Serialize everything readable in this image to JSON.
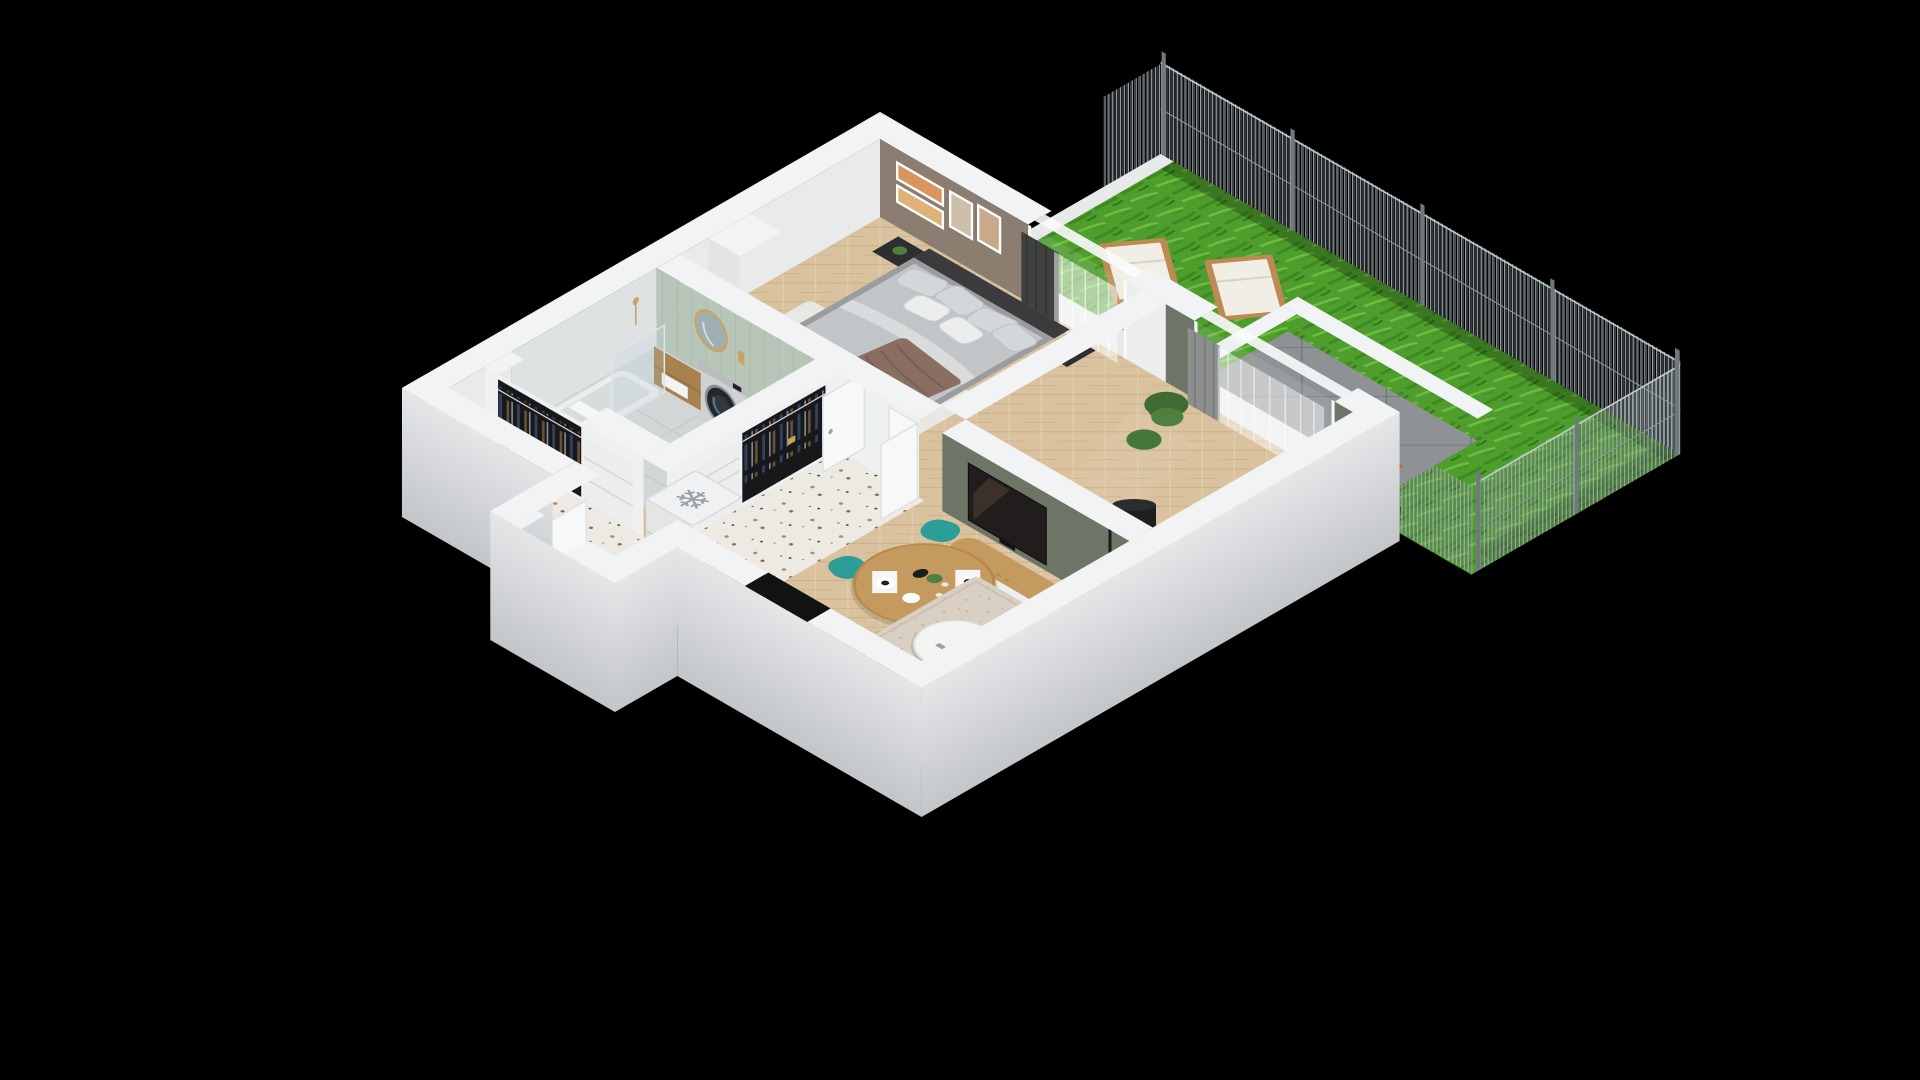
{
  "title": "3D isometric apartment floor plan with garden",
  "icons": {
    "freezer": "❄"
  },
  "palette": {
    "bg": "#000000",
    "wallTop": "#f2f3f4",
    "wallExt1": "#e4e6e8",
    "wallExt2": "#c3c6c9",
    "wallInner": "#eef0f1",
    "taupe": "#8b7e71",
    "sage": "#b7c6b8",
    "partition": "#6d7567",
    "wood1": "#d9c29d",
    "wood2": "#cbb188",
    "terrazzo": "#edeae4",
    "bathFloor": "#d3d6d7",
    "terrace": "#8e9294",
    "terraceLine": "#6f7478",
    "grass1": "#4f9e2d",
    "grass2": "#3a8a1e",
    "grass3": "#6dbf40",
    "fence": "#9fabaf",
    "rug": "#d9cfc2",
    "sofa": "#7c4a43",
    "teal": "#2d9d95",
    "tv": "#201d1c",
    "counter": "#3a3c3d",
    "gold": "#c9a35f",
    "woodFurn": "#c59a5e",
    "curtainDark": "#3f4140",
    "curtainGray": "#8c8f8e",
    "whiteFurn": "#f4f5f5"
  },
  "scene": {
    "background": "#000000",
    "view": "isometric cut-away 3D render on black background",
    "garden": {
      "ground": "lawn",
      "items": [
        "wire-mesh-fence",
        "sun-lounger",
        "sun-lounger"
      ]
    },
    "terrace": {
      "ground": "large gray tiles",
      "items": [
        "low-white-wall",
        "doormat",
        "sheer-curtains"
      ]
    },
    "rooms": [
      {
        "name": "Bedroom",
        "floor": "herringbone-wood",
        "items": [
          "double-bed",
          "gray-bedding",
          "pillows",
          "brown-throw",
          "white-rug",
          "nightstand",
          "nightstand",
          "black-table-lamp",
          "four-wall-frames",
          "open-wardrobe-with-clothes",
          "dresser",
          "dark-curtains",
          "sheer-curtains"
        ]
      },
      {
        "name": "Bathroom",
        "floor": "ceramic-tiles",
        "items": [
          "bathtub",
          "glass-shower-screen",
          "gold-round-mirror",
          "wood-vanity-with-washbasin",
          "washing-machine",
          "toilet",
          "wood-wall-shelf",
          "gold-fixtures"
        ]
      },
      {
        "name": "Hallway",
        "floor": "terrazzo",
        "items": [
          "open-wardrobe-with-clothes",
          "white-cabinet",
          "second-wardrobe",
          "white-cabinet",
          "fridge-freezer",
          "entry-door",
          "bathroom-door",
          "bedroom-double-doors"
        ]
      },
      {
        "name": "Living room",
        "floor": "herringbone-wood",
        "items": [
          "green-tv-partition-wall",
          "flat-tv",
          "media-sideboard",
          "round-dining-table",
          "teal-chair",
          "teal-chair",
          "teal-chair",
          "tableware",
          "area-rug",
          "round-coffee-table",
          "gold-vase",
          "burgundy-sofa",
          "black-floor-lamp",
          "potted-plants"
        ]
      },
      {
        "name": "Kitchen",
        "floor": "herringbone-wood",
        "items": [
          "dark-countertop",
          "sink",
          "faucet",
          "fruit-bowl-green-apples",
          "hob-with-pans",
          "kettle",
          "window-opening"
        ]
      }
    ]
  }
}
